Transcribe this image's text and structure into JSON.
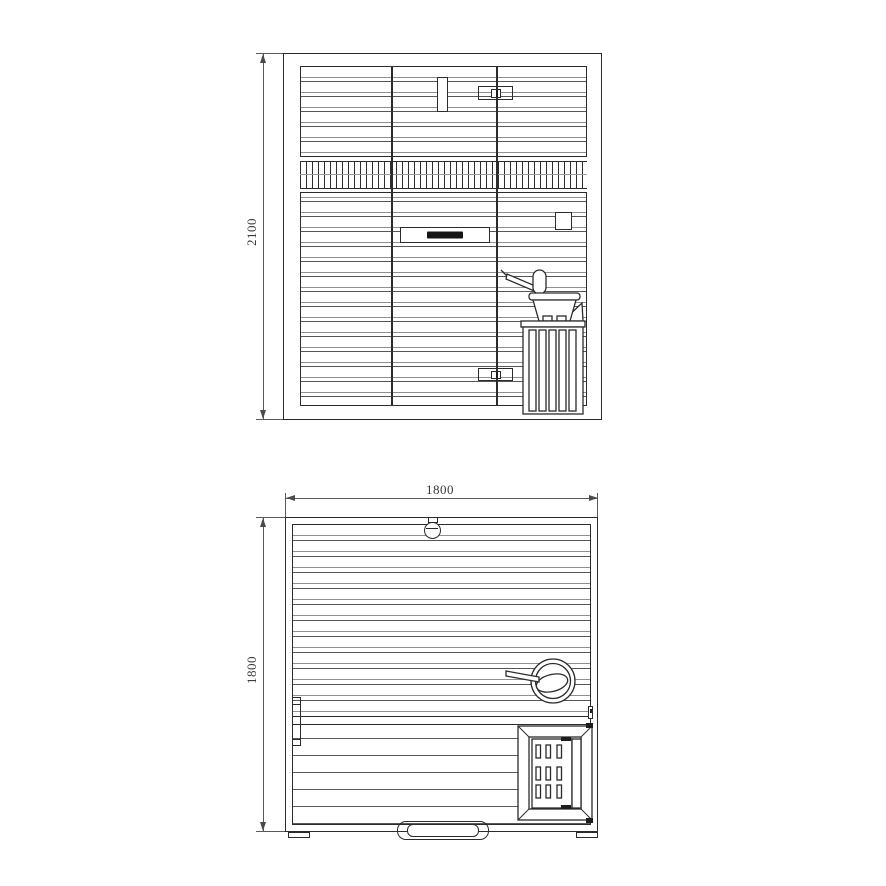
{
  "colors": {
    "ink": "#2b2b2b",
    "ink_light": "#909090",
    "background": "#ffffff"
  },
  "front_view": {
    "height_label": "2100"
  },
  "plan_view": {
    "width_label": "1800",
    "depth_label": "1800"
  }
}
